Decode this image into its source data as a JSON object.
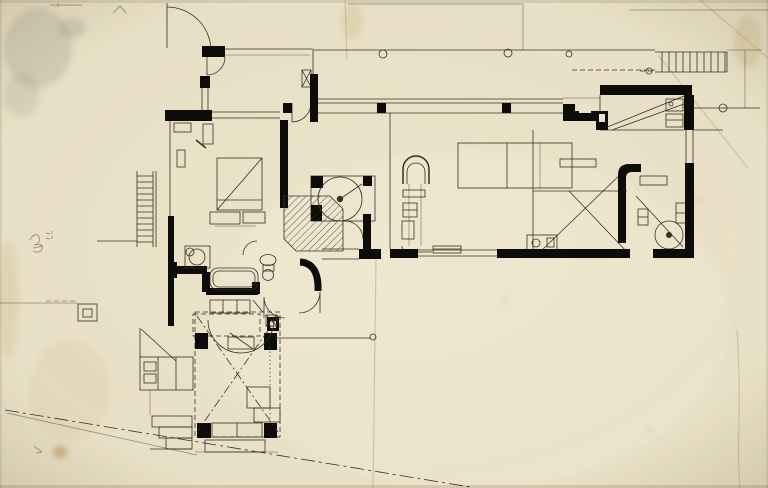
{
  "document": {
    "kind": "Scanned architectural floor plan drawing",
    "aria_label": "Modernist house floor plan drawn in black ink on aged cream paper, with heavy poche walls, door swings, stairs, furniture symbols, hatched stair hall, dashed pilotis terrace, a diagonal property line, fold creases, stains and an illegible pencil inscription"
  },
  "colors": {
    "paper": "#ece4ca",
    "paper-light": "#f5efdb",
    "ink": "#373023",
    "ink-strong": "#0e0c08",
    "pencil": "#8f8671",
    "crease": "#c3b690",
    "stain-gray": "#8d8a7e",
    "stain-brown": "#b08a3e",
    "vignette": "#6d6040"
  },
  "symbols": {
    "wall-poche": "solid black filled wall",
    "door-swing": "quarter-circle arc",
    "stair-treads": "parallel tread lines",
    "ladder": "double rail with rungs",
    "hatching": "45-degree line fill",
    "column": "small filled black square",
    "round-column": "small open circle",
    "spiral-stair": "circle with center dot",
    "property-line": "dash-dot diagonal",
    "fold-crease": "faint tan line",
    "stain": "soft blotch",
    "pencil-inscription": "illegible scribble"
  }
}
